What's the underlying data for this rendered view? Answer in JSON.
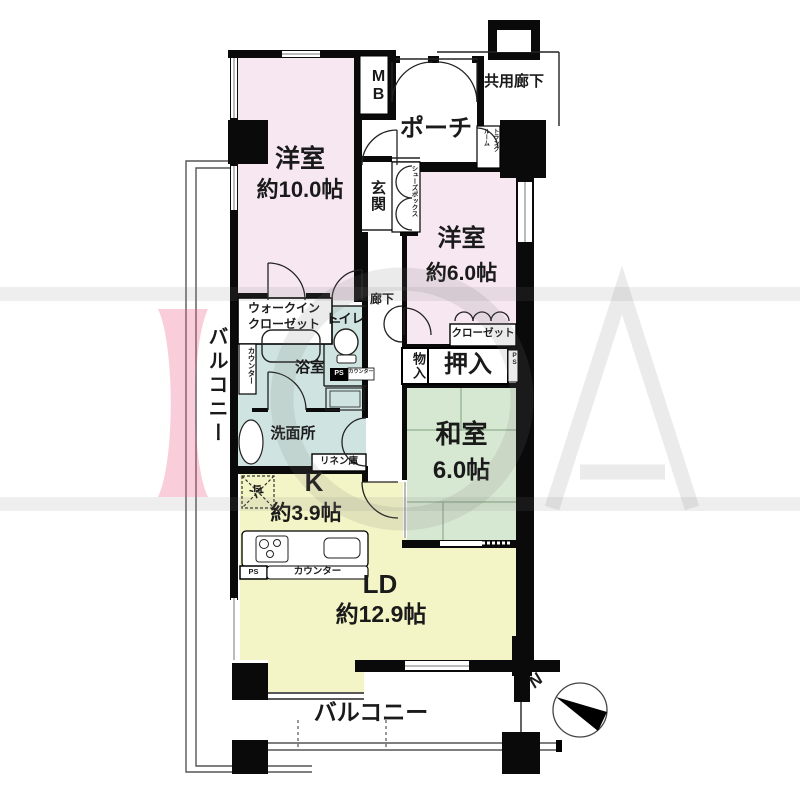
{
  "rooms": {
    "bedroom_main": {
      "name": "洋室",
      "size": "約10.0帖"
    },
    "bedroom_second": {
      "name": "洋室",
      "size": "約6.0帖"
    },
    "japanese_room": {
      "name": "和室",
      "size": "6.0帖"
    },
    "kitchen": {
      "name": "K",
      "size": "約3.9帖"
    },
    "living_dining": {
      "name": "LD",
      "size": "約12.9帖"
    }
  },
  "areas": {
    "porch": "ポーチ",
    "common_corridor": "共用廊下",
    "meter_box": "MB",
    "entrance": "玄関",
    "shoe_box": "シューズボックス",
    "trunk_room": "トランク\nルーム",
    "hallway": "廊下",
    "walk_in_closet": "ウォークイン\nクローゼット",
    "counter_side": "カウンター",
    "toilet": "トイレ",
    "bath": "浴室",
    "pipe_space_toilet": "PS",
    "counter_toilet": "カウンター",
    "washroom": "洗面所",
    "linen": "リネン庫",
    "closet": "クローゼット",
    "storage": "物入",
    "oshiire": "押入",
    "pipe_space_right": "PS",
    "refrigerator": "冷",
    "pipe_space_kitchen": "PS",
    "counter_kitchen": "カウンター",
    "balcony_left": "バルコニー",
    "balcony_bottom": "バルコニー",
    "north_mark": "N"
  },
  "colors": {
    "room_pink": "#f6e7f0",
    "water_blue": "#cfe4e0",
    "tatami_green": "#d7e8d2",
    "kitchen_yellow": "#f4f5c6",
    "wall_black": "#0a0a0a",
    "watermark_pink": "#ef5e86",
    "watermark_gray": "#9a9a9a"
  }
}
